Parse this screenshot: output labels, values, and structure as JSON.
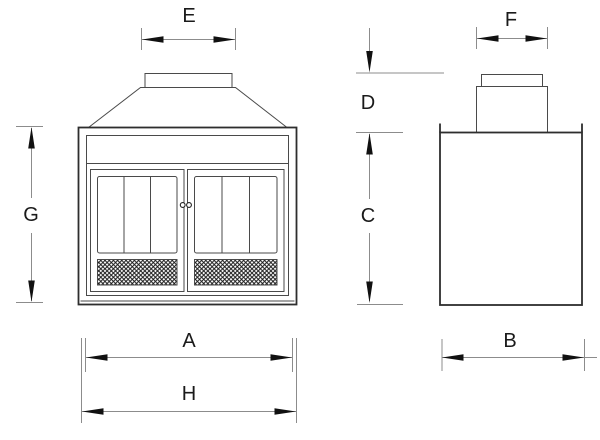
{
  "diagram": {
    "colors": {
      "background": "#ffffff",
      "outline_color": "#2e2e2e",
      "detail_color": "#4a4a4a",
      "dim_line_color": "#8c8c8c",
      "arrow_color": "#111111",
      "label_color": "#1a1a1a",
      "mesh_color": "#1c1c1c"
    },
    "labels": {
      "A": "A",
      "B": "B",
      "C": "C",
      "D": "D",
      "E": "E",
      "F": "F",
      "G": "G",
      "H": "H"
    }
  }
}
